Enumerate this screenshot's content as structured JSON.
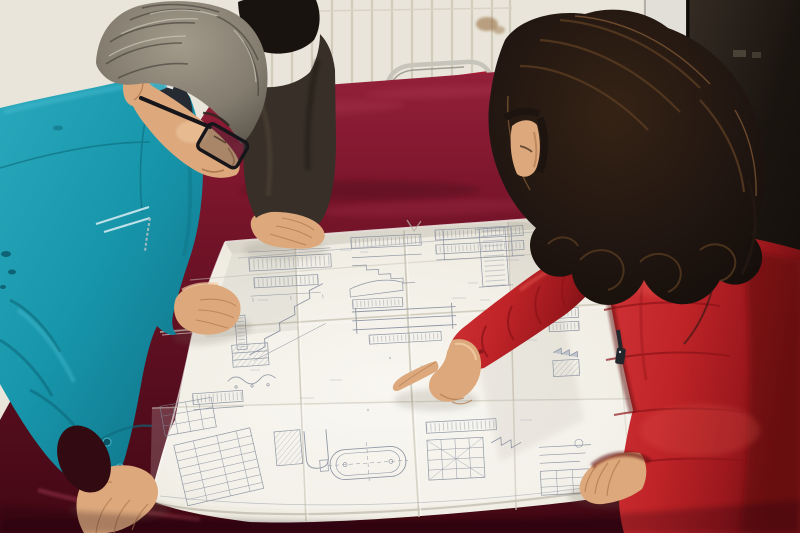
{
  "scene": {
    "type": "photograph",
    "setting": "Two workers and a woman in a red winter coat review a large folded engineering blueprint spread on a dark red velvet-covered table, in front of a white radiator wall and a dark door.",
    "labels": {
      "photo": "Photograph of three people reviewing an engineering blueprint on a velvet-covered table",
      "wall": "White wall with vertical radiator slats",
      "stain": "Brown stain on the wall",
      "doorFrame": "Light door-frame strip",
      "door": "Dark door at the right edge",
      "chair": "Red chair with chrome tube frame behind the table",
      "table": "Table draped with dark red velvet cloth",
      "blueprint": "Large folded engineering drawing sheet with many small structural details",
      "manLeft": "Gray-haired man wearing glasses and a teal work jacket leaning over the drawing",
      "manGlasses": "Dark rectangular eyeglasses",
      "personBehind": "Second person in a dark jacket resting a hand on the drawing",
      "womanRight": "Woman in a red down coat with fur-trimmed hood",
      "womanHair": "Long dark wavy hair",
      "furTrim": "Orange-brown fur trim of the hood",
      "pointingHand": "Woman's hand pointing at a detail on the drawing",
      "zipperPull": "Dangling zipper pull on the red coat"
    }
  },
  "palette": {
    "wall": "#e9e5da",
    "wallSlat": "#cfc8b6",
    "wallSeam": "#d9d3c5",
    "stain": "#8a5a28",
    "frameStrip": "#e2dfd8",
    "frameEdge": "#b5b0a5",
    "doorTop": "#352c24",
    "doorBottom": "#140f0b",
    "hinge": "#4a4237",
    "chrome": "#c7c4bb",
    "chairRed": "#b01b2e",
    "velvetTop": "#932039",
    "velvetMid": "#6d1226",
    "velvetDark": "#420813",
    "velvetSheen": "#b03a55",
    "paperBright": "#f8f6f0",
    "paperBase": "#f0ede4",
    "paperDim": "#ded9ca",
    "crease": "#c7c2b2",
    "ink": "#7e8798",
    "inkDark": "#5f6a7e",
    "tealBase": "#1795aa",
    "tealDark": "#0d6a7c",
    "tealDeep": "#0a5565",
    "tealLight": "#44b9cc",
    "tealPale": "#cfe9ef",
    "manHair": "#8a8376",
    "manHairDark": "#46413a",
    "manHairLight": "#cfc9ba",
    "skin": "#dca87c",
    "skinLight": "#f2cda4",
    "skinShadow": "#b17c52",
    "innerShirt": "#262b33",
    "darkJacket": "#382f28",
    "darkJacketHi": "#534739",
    "blackHair": "#191310",
    "womanHair": "#1d1410",
    "womanHairHi": "#5a3c22",
    "womanHairRim": "#8a6038",
    "coatBase": "#c32830",
    "coatLight": "#e2544e",
    "coatDark": "#8c1318",
    "coatDeep": "#600c10",
    "fur": "#c57c28",
    "furDark": "#6e4012",
    "furLight": "#e8a848",
    "zipper": "#23262b"
  }
}
